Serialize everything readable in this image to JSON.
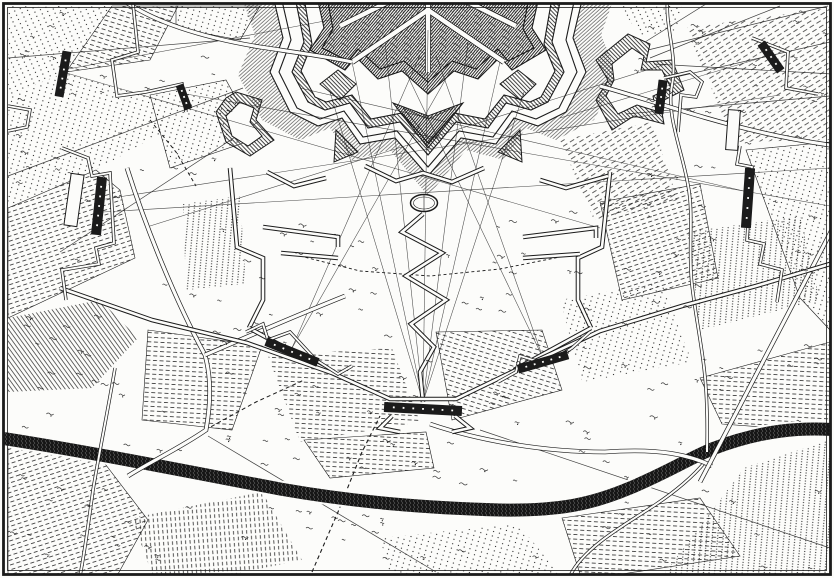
{
  "map": {
    "colors": {
      "ink": "#1b1b1b",
      "paper": "#fcfcfa",
      "river": "#161616"
    },
    "frame": {
      "outer": [
        3.5,
        3.5,
        827,
        571
      ],
      "inner": [
        7.5,
        7.5,
        819,
        563
      ]
    },
    "patterns": {
      "pDotsA": {
        "type": "dots",
        "sx": 6,
        "sy": 4.6,
        "r": 0.62,
        "a": 16
      },
      "pDotsB": {
        "type": "dots",
        "sx": 6,
        "sy": 4.6,
        "r": 0.62,
        "a": -24
      },
      "pDotsV": {
        "type": "dots",
        "sx": 5.5,
        "sy": 2.7,
        "r": 0.6,
        "a": 5
      },
      "pDashA": {
        "type": "dash",
        "len": 4,
        "gap": 2.6,
        "row": 4.6,
        "w": 0.75,
        "a": 3
      },
      "pDashB": {
        "type": "dash",
        "len": 4,
        "gap": 2.6,
        "row": 4.6,
        "w": 0.75,
        "a": 17
      },
      "pDashC": {
        "type": "dash",
        "len": 4,
        "gap": 2.6,
        "row": 4.6,
        "w": 0.75,
        "a": -18
      },
      "pDashV": {
        "type": "dash",
        "len": 3.6,
        "gap": 2.4,
        "row": 4.4,
        "w": 0.75,
        "a": 86
      },
      "pDashD": {
        "type": "dash",
        "len": 5,
        "gap": 3,
        "row": 5,
        "w": 0.7,
        "a": -32
      },
      "pHatchA": {
        "type": "lines",
        "sp": 3.6,
        "w": 0.65,
        "a": -36
      },
      "pGlacis": {
        "type": "lines",
        "sp": 2.7,
        "w": 0.5,
        "a": 48
      },
      "pRampA": {
        "type": "lines",
        "sp": 2.9,
        "w": 0.8,
        "a": -44
      },
      "pRampB": {
        "type": "lines",
        "sp": 2.2,
        "w": 0.95,
        "a": 40
      },
      "pStip": {
        "type": "stip"
      },
      "pRiver": {
        "type": "rivtex"
      }
    },
    "fields": [
      {
        "pts": "8,6 112,6 66,72 8,96",
        "pat": "pDotsB"
      },
      {
        "pts": "112,6 178,6 150,60 66,72",
        "pat": "pDashB"
      },
      {
        "pts": "8,96 66,72 150,95 170,128 96,170 8,208",
        "pat": "pDotsA"
      },
      {
        "pts": "8,208 96,170 120,190 135,258 8,318",
        "pat": "pDashC"
      },
      {
        "pts": "8,318 100,300 138,338 92,388 8,392",
        "pat": "pHatchA"
      },
      {
        "pts": "150,95 226,80 258,138 170,168",
        "pat": "pDotsA"
      },
      {
        "pts": "183,204 240,196 246,284 186,290",
        "pat": "pDotsV"
      },
      {
        "pts": "148,330 262,346 232,430 142,420",
        "pat": "pDashA"
      },
      {
        "pts": "268,356 392,348 420,422 300,442",
        "pat": "pDashA"
      },
      {
        "pts": "436,332 542,330 562,390 452,420",
        "pat": "pDashB"
      },
      {
        "pts": "560,300 662,282 692,362 582,382",
        "pat": "pDotsA"
      },
      {
        "pts": "8,446 96,452 148,520 118,574 8,574",
        "pat": "pDashC"
      },
      {
        "pts": "132,518 262,492 302,560 234,574 152,574",
        "pat": "pDashV"
      },
      {
        "pts": "304,440 426,432 434,468 330,478",
        "pat": "pDashA"
      },
      {
        "pts": "380,538 518,524 560,574 390,574",
        "pat": "pDotsA"
      },
      {
        "pts": "562,518 700,498 740,556 622,574 580,574",
        "pat": "pDashA"
      },
      {
        "pts": "744,468 830,440 830,574 664,574",
        "pat": "pDotsV"
      },
      {
        "pts": "700,378 830,342 830,432 722,424",
        "pat": "pDashA"
      },
      {
        "pts": "688,232 800,216 820,300 700,330",
        "pat": "pDotsV"
      },
      {
        "pts": "746,150 830,142 830,330 800,298",
        "pat": "pDotsA"
      },
      {
        "pts": "686,28 830,8 830,140 734,142",
        "pat": "pDashD"
      },
      {
        "pts": "600,202 700,184 718,278 622,300",
        "pat": "pDashC"
      },
      {
        "pts": "560,140 652,122 678,200 594,220",
        "pat": "pDashD"
      },
      {
        "pts": "176,6 260,6 240,40 176,28",
        "pat": "pDotsA"
      },
      {
        "pts": "620,6 682,6 676,30 640,36",
        "pat": "pDotsB"
      }
    ],
    "thin_lines": [
      "M250,38 L8,58",
      "M243,88 L8,176",
      "M258,122 L60,252",
      "M610,92 L830,42",
      "M626,114 L830,96",
      "M480,430 L830,548",
      "M208,436 L436,572",
      "M648,50 L828,6",
      "M654,64 L832,74",
      "M650,58 L780,6",
      "M645,42 L706,4"
    ],
    "fortress": {
      "stack": [
        {
          "d": "M240,-8 L255,35 L238,75 L262,120 L300,140 L330,128 L352,160 L390,150 L428,196 L466,150 L504,160 L526,128 L556,140 L594,120 L618,75 L601,35 L616,-8 Z",
          "fill": "pGlacis",
          "stroke": false
        },
        {
          "d": "M272,-8 L283,38 L270,72 L290,112 L318,126 L342,118 L360,144 L395,138 L428,176 L461,138 L496,144 L514,118 L538,126 L566,112 L586,72 L573,38 L584,-8 Z",
          "fill": "paper",
          "stroke": true
        },
        {
          "d": "M280,-8 L291,40 L279,72 L297,108 L320,119 L344,111 L363,137 L397,131 L428,167 L459,131 L493,137 L512,111 L536,119 L559,108 L577,72 L566,40 L576,-8 Z",
          "fill": "paper",
          "stroke": true
        },
        {
          "d": "M294,-8 L304,42 L292,72 L308,102 L325,110 L350,103 L368,128 L400,122 L428,155 L456,122 L488,128 L506,103 L531,110 L548,102 L564,72 L552,42 L562,-8 Z",
          "fill": "pRampA",
          "stroke": true
        },
        {
          "d": "M303,-8 L312,44 L301,71 L315,97 L326,102 L352,95 L371,119 L402,113 L428,143 L454,113 L485,119 L504,95 L530,102 L541,97 L555,71 L544,44 L553,-8 Z",
          "fill": "paper",
          "stroke": true
        },
        {
          "d": "M316,-8 L324,28 L310,50 L345,70 L356,57 L378,79 L402,71 L428,94 L454,71 L478,79 L500,57 L512,70 L546,50 L532,28 L540,-8 Z",
          "fill": "pRampB",
          "stroke": true
        },
        {
          "d": "M326,-8 L333,29 L322,48 L348,61 L358,49 L380,69 L404,61 L428,82 L452,61 L476,69 L498,49 L508,61 L534,48 L523,29 L530,-8 Z",
          "fill": "pStip",
          "stroke": true
        }
      ],
      "outworks": [
        {
          "d": "M393,103 L428,148 L463,103 L428,116 Z",
          "fill": "pRampB"
        },
        {
          "d": "M403,108 L428,138 L453,108 L428,119 Z",
          "fill": "none"
        },
        {
          "d": "M320,84 L340,100 L356,84 L338,70 Z",
          "fill": "pRampA"
        },
        {
          "d": "M500,84 L520,100 L536,84 L518,70 Z",
          "fill": "pRampA"
        },
        {
          "d": "M336,130 L358,152 L334,162 Z",
          "fill": "pRampA"
        },
        {
          "d": "M520,130 L498,152 L522,162 Z",
          "fill": "pRampA"
        },
        {
          "d": "M236,92 L262,100 L256,120 L274,140 L250,156 L226,142 L216,112 L226,98 Z",
          "fill": "pRampA"
        },
        {
          "d": "M240,102 L254,108 L250,122 L262,136 L248,146 L232,136 L226,116 Z",
          "fill": "paper"
        },
        {
          "d": "M596,60 L628,34 L650,44 L646,62 L672,60 L684,90 L660,102 L664,124 L634,116 L612,130 L596,100 L608,80 Z",
          "fill": "pRampA"
        },
        {
          "d": "M612,64 L632,48 L644,56 L641,70 L662,70 L671,88 L653,96 L656,111 L637,105 L618,114 L606,96 L614,80 Z",
          "fill": "paper"
        }
      ],
      "streets": [
        "M428,-4 L428,72",
        "M428,10 L352,62",
        "M428,10 L504,62",
        "M400,-4 L340,26",
        "M456,-4 L516,26"
      ],
      "oval": {
        "cx": 424,
        "cy": 203,
        "rx": 13.5,
        "ry": 8.5
      }
    },
    "fire_lines": [
      "M423,402 L352,62",
      "M423,402 L385,42",
      "M423,402 L428,30",
      "M423,402 L468,42",
      "M423,402 L500,62",
      "M423,402 L330,92",
      "M423,402 L524,92",
      "M292,348 L420,55",
      "M292,348 L452,68",
      "M543,358 L436,55",
      "M543,358 L404,68",
      "M99,200 L780,95",
      "M103,212 L830,168",
      "M63,72 L600,228",
      "M666,64 L150,226",
      "M748,192 L300,88",
      "M186,94 L830,206",
      "M63,70 L330,20",
      "M771,55 L560,118"
    ],
    "dashed_paths": [
      {
        "d": "M312,572 L338,512 L362,452 L380,416",
        "dash": "4 3",
        "w": 1.1
      },
      {
        "d": "M300,256 L360,271 L430,276 L500,269 L560,257",
        "dash": "3 2.6",
        "w": 0.9
      },
      {
        "d": "M150,120 L176,152 L196,186",
        "dash": "3.5 3",
        "w": 1
      },
      {
        "d": "M205,430 L256,402 L304,380",
        "dash": "4 3",
        "w": 1
      }
    ],
    "river": {
      "d": "M-6,437 C80,450 180,470 280,489 C360,503 430,508 500,510 C560,511 592,504 630,488 C668,472 690,458 712,449 C762,430 800,427 840,430",
      "w": 13
    },
    "streams": [
      "M668,-4 C664,25 678,55 672,85 C666,115 682,150 688,185 C694,215 688,250 692,285 C696,320 704,355 706,390 C708,420 707,440 707,452",
      "M705,462 C690,480 670,495 655,505 C635,518 615,530 600,542 C585,554 575,565 570,576",
      "M115,368 C108,410 100,448 93,490 C89,520 85,550 80,576"
    ],
    "roads": [
      "M118,-4 C150,22 205,38 260,47 C300,53 330,57 352,62",
      "M127,168 C145,225 175,300 205,355 C212,380 210,408 206,430 C180,448 150,462 128,476",
      "M205,355 C240,340 290,318 345,296",
      "M430,424 C480,441 545,452 605,452 C660,448 690,455 712,466",
      "M836,222 L700,482",
      "M600,86 C650,100 700,118 760,132 C790,139 815,143 836,146"
    ],
    "trenches": [
      "M423,214 L402,232 L442,253 L406,276 L446,300 L411,324 L434,347 L420,372 L423,402",
      "M230,168 L237,247 L263,258 L263,300 L249,328",
      "M263,227 L338,237 L338,247",
      "M281,253 L338,258",
      "M267,172 L294,186 L326,178",
      "M249,328 L330,372",
      "M610,172 L602,247 L578,258 L578,300 L591,328",
      "M523,237 L596,228 L596,238",
      "M523,258 L580,254",
      "M608,176 L566,188 L540,180",
      "M591,328 L514,370",
      "M60,288 L152,320 L247,343 L332,373 L390,399 L456,399 L514,371 L600,331 L682,306 L756,286 L830,264",
      "M365,166 L396,181 L423,173 L452,182 L484,168",
      "M392,416 L380,428 L400,432",
      "M455,416 L470,428 L452,432"
    ],
    "circumvallation": [
      "M133,4 L138,52 L112,60 L117,96 L146,92 L182,84 L186,112",
      "M62,148 L88,158 L92,176 L110,173 L114,243 L96,248 L99,264 L62,270 L66,300",
      "M8,106 L30,110 L27,127 L8,131",
      "M246,332 L263,324 L268,340 L290,332 L316,360 L338,374 L352,366",
      "M498,382 L516,372 L520,356 L546,364 L572,348 L590,332",
      "M740,146 L737,164 L752,167 L747,240 L764,244 L760,264 L782,270 L777,302",
      "M664,78 L690,72 L702,82 L696,97 L681,95 L678,132",
      "M752,38 L788,52 L786,88 L818,94"
    ],
    "redoubts": [
      {
        "x": 74,
        "y": 200,
        "w": 13,
        "h": 52,
        "a": 8
      },
      {
        "x": 733,
        "y": 130,
        "w": 12,
        "h": 40,
        "a": 4
      }
    ],
    "batteries": [
      {
        "x": 63,
        "y": 74,
        "l": 46,
        "w": 9,
        "a": 100,
        "n": 4
      },
      {
        "x": 184,
        "y": 97,
        "l": 26,
        "w": 8,
        "a": 70,
        "n": 3
      },
      {
        "x": 99,
        "y": 206,
        "l": 58,
        "w": 10,
        "a": 96,
        "n": 5
      },
      {
        "x": 292,
        "y": 352,
        "l": 56,
        "w": 9,
        "a": 22,
        "n": 5
      },
      {
        "x": 543,
        "y": 362,
        "l": 52,
        "w": 9,
        "a": -16,
        "n": 5
      },
      {
        "x": 423,
        "y": 409,
        "l": 78,
        "w": 10,
        "a": 3,
        "n": 7
      },
      {
        "x": 748,
        "y": 198,
        "l": 60,
        "w": 10,
        "a": 94,
        "n": 5
      },
      {
        "x": 661,
        "y": 97,
        "l": 34,
        "w": 9,
        "a": 97,
        "n": 3
      },
      {
        "x": 771,
        "y": 57,
        "l": 34,
        "w": 9,
        "a": 55,
        "n": 3
      }
    ],
    "tufts": {
      "n": 250,
      "seed": 11
    },
    "river_line": [
      [
        0,
        437
      ],
      [
        280,
        489
      ],
      [
        500,
        510
      ],
      [
        630,
        488
      ],
      [
        712,
        449
      ],
      [
        834,
        430
      ]
    ]
  }
}
